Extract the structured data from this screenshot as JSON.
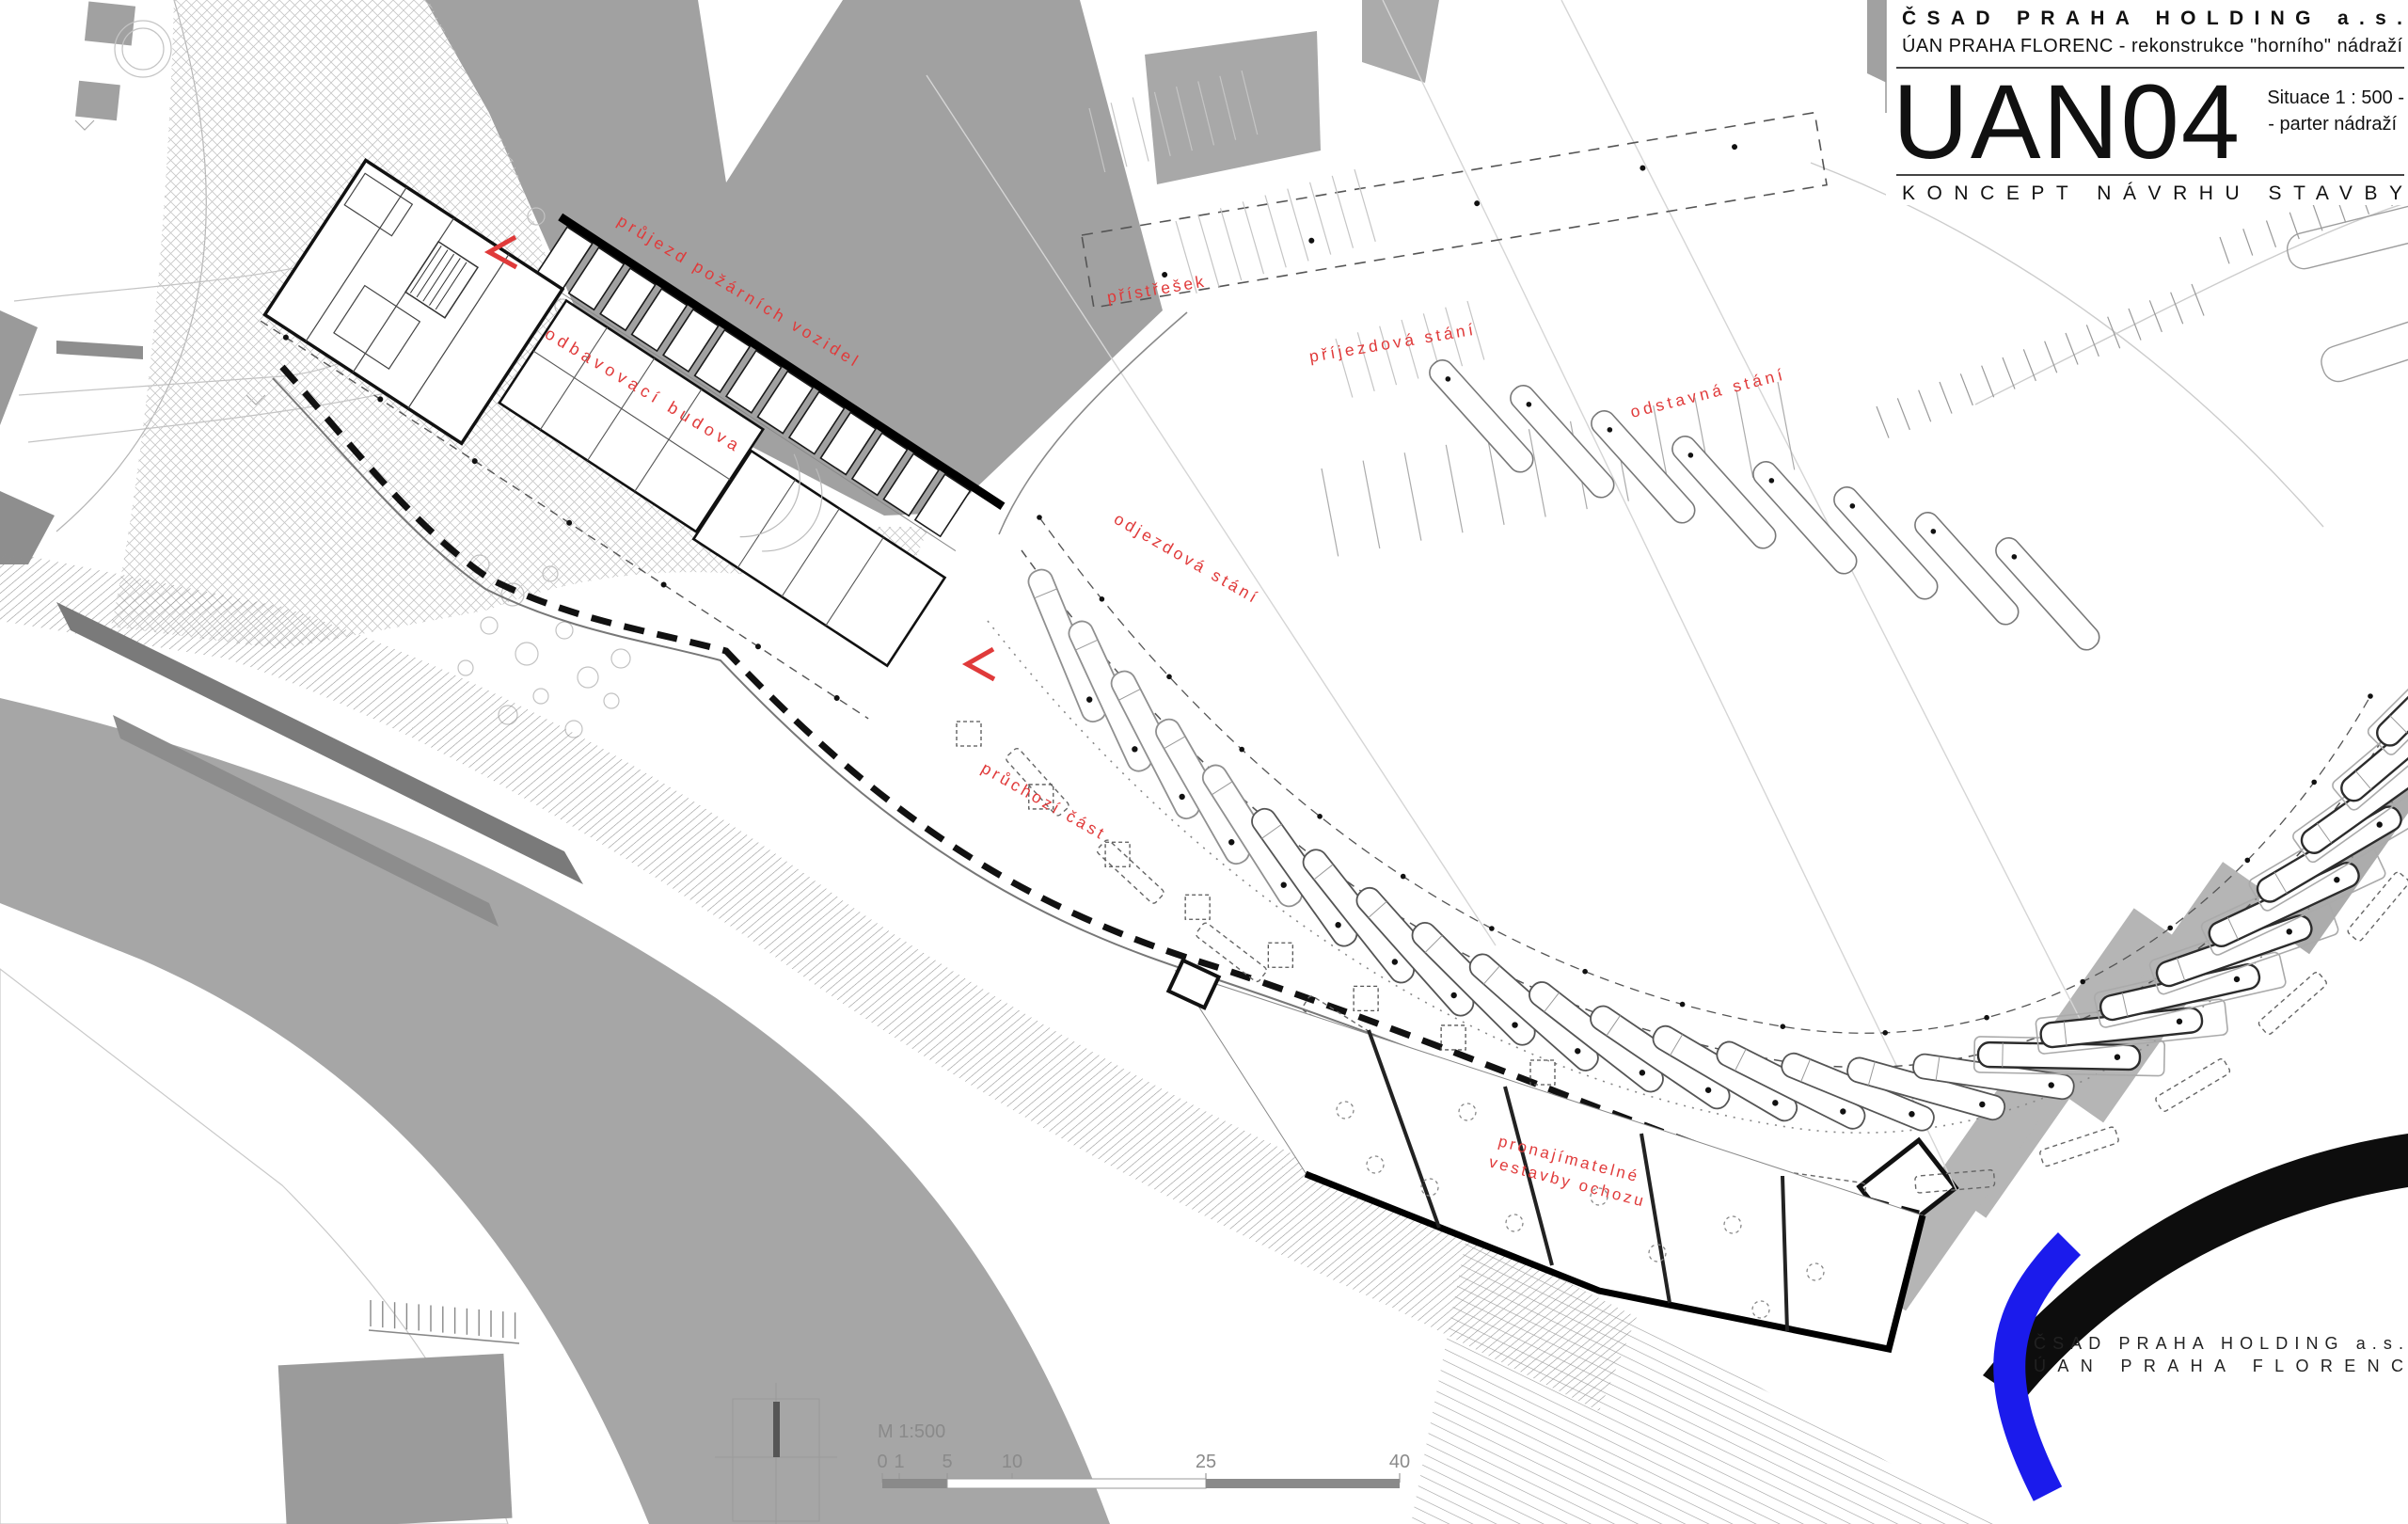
{
  "title_block": {
    "company": "ČSAD PRAHA HOLDING a.s.",
    "project": "ÚAN PRAHA FLORENC - rekonstrukce \"horního\" nádraží",
    "drawing_code": "UAN04",
    "scale_note_line1": "Situace 1 : 500 -",
    "scale_note_line2": "- parter nádraží",
    "phase": "KONCEPT NÁVRHU STAVBY"
  },
  "plan_labels": {
    "fire_lane": "průjezd požárních vozidel",
    "terminal_building": "odbavovací budova",
    "shelter": "přístřešek",
    "arrival_stands": "příjezdová stání",
    "layover_stands": "odstavná stání",
    "departure_stands": "odjezdová stání",
    "walkthrough": "průchozí část",
    "lettable_line1": "pronajímatelné",
    "lettable_line2": "vestavby ochozu"
  },
  "logo_block": {
    "company": "ČSAD PRAHA HOLDING a.s.",
    "site": "ÚAN PRAHA FLORENC"
  },
  "scale_bar": {
    "label": "M 1:500",
    "ticks": [
      "0",
      "1",
      "5",
      "10",
      "25",
      "40"
    ]
  },
  "colors": {
    "annotation_red": "#e03a3a",
    "logo_blue": "#1b1bec",
    "building_gray": "#a1a1a1"
  }
}
